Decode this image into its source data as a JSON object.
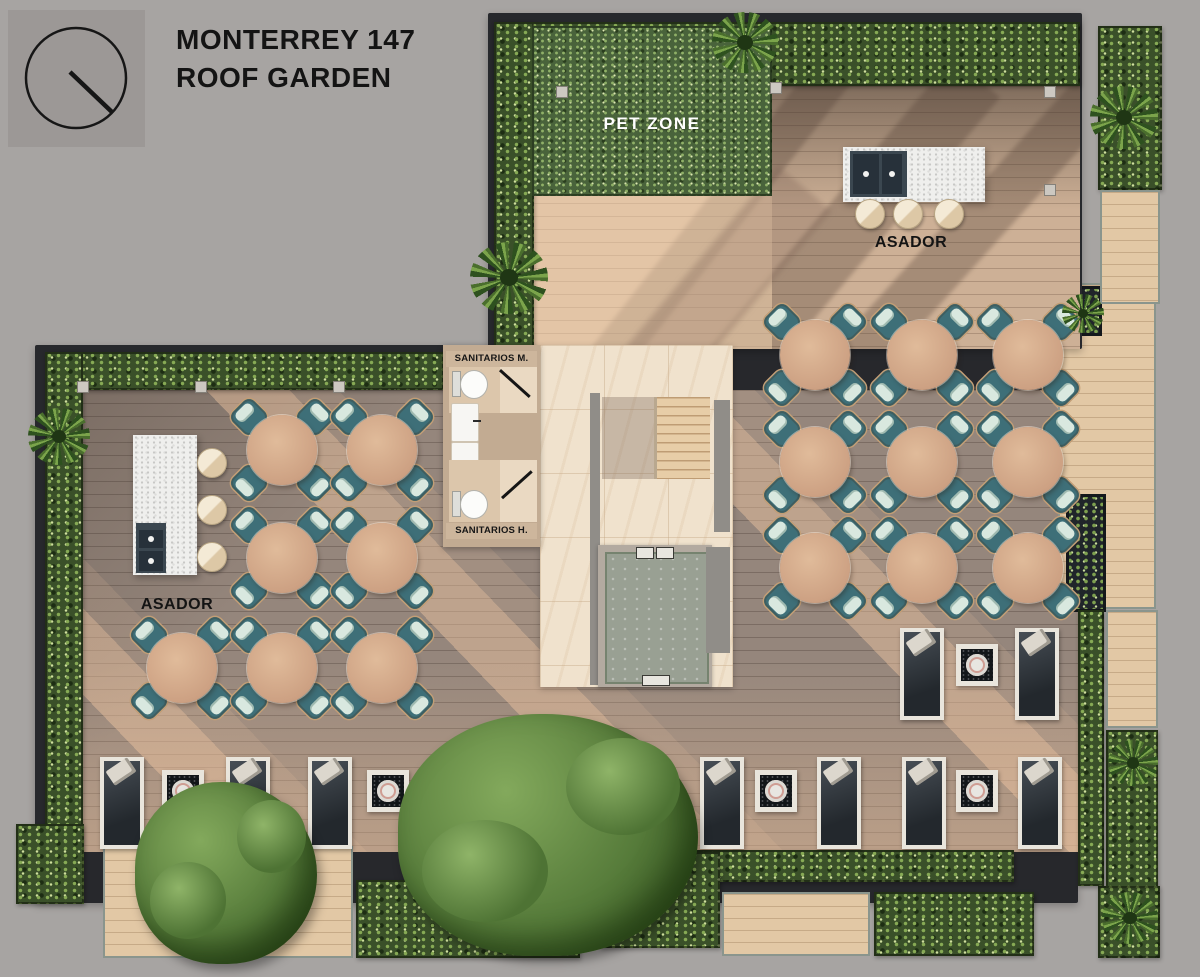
{
  "legend": {
    "title_line1": "MONTERREY 147",
    "title_line2": "ROOF GARDEN",
    "north_icon": "north-indicator-icon"
  },
  "labels": {
    "pet_zone": "PET ZONE",
    "asador_upper": "ASADOR",
    "asador_left": "ASADOR",
    "sanitarios_m": "SANITARIOS M.",
    "sanitarios_h": "SANITARIOS H."
  },
  "inventory": {
    "dining_tables": 16,
    "dining_chairs": 64,
    "sun_loungers": 12,
    "side_tables": 6,
    "bar_stools": 6,
    "grill_islands": 2,
    "toilets": 2,
    "sinks": 2,
    "large_trees": 2
  },
  "palette": {
    "background": "#a7a4a2",
    "deck_dark": "#95867c",
    "deck_light": "#e2c8a5",
    "hedge_green": "#3a5029",
    "pet_zone_green": "#49633b",
    "table_wood": "#d7b193",
    "chair_teal": "#3e6f78",
    "chair_cushion": "#d9e8df",
    "island_white": "#efefed",
    "grill_slate": "#3b4750",
    "marble": "#f0e2cd",
    "stair_tan": "#e7cda7",
    "lounger_dark": "#23282d",
    "text_dark": "#141414",
    "text_light": "#ffffff"
  }
}
